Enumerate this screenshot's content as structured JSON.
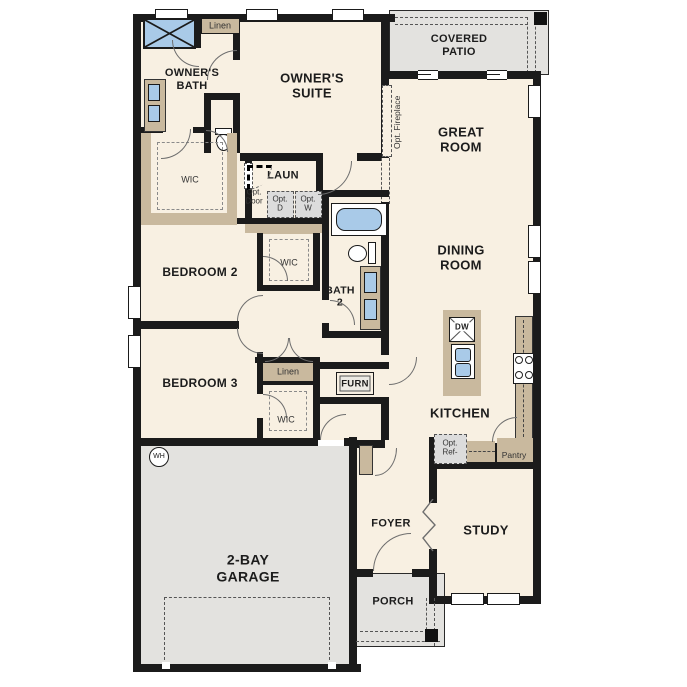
{
  "labels": {
    "owners_bath": "OWNER'S\nBATH",
    "owners_suite": "OWNER'S\nSUITE",
    "wic": "WIC",
    "linen": "Linen",
    "laundry": "LAUN",
    "opt_door": "Opt.\nDoor",
    "opt_d": "Opt.\nD",
    "opt_w": "Opt.\nW",
    "covered_patio": "COVERED\nPATIO",
    "great_room": "GREAT\nROOM",
    "opt_fireplace": "Opt. Fireplace",
    "dining_room": "DINING\nROOM",
    "bedroom2": "BEDROOM 2",
    "bath2": "BATH\n2",
    "bedroom3": "BEDROOM 3",
    "furnace": "FURN",
    "kitchen": "KITCHEN",
    "dishwasher": "DW",
    "opt_ref": "Opt.\nRef-",
    "pantry": "Pantry",
    "study": "STUDY",
    "foyer": "FOYER",
    "porch": "PORCH",
    "garage": "2-BAY\nGARAGE",
    "water_heater": "WH"
  },
  "colors": {
    "floor": "#f8f0e2",
    "wall": "#1b1b1b",
    "cabinet_tan": "#c9b99e",
    "exterior_gray": "#e3e2df",
    "fixture_blue": "#a9cae8",
    "option_fill": "#dcdcdc"
  }
}
